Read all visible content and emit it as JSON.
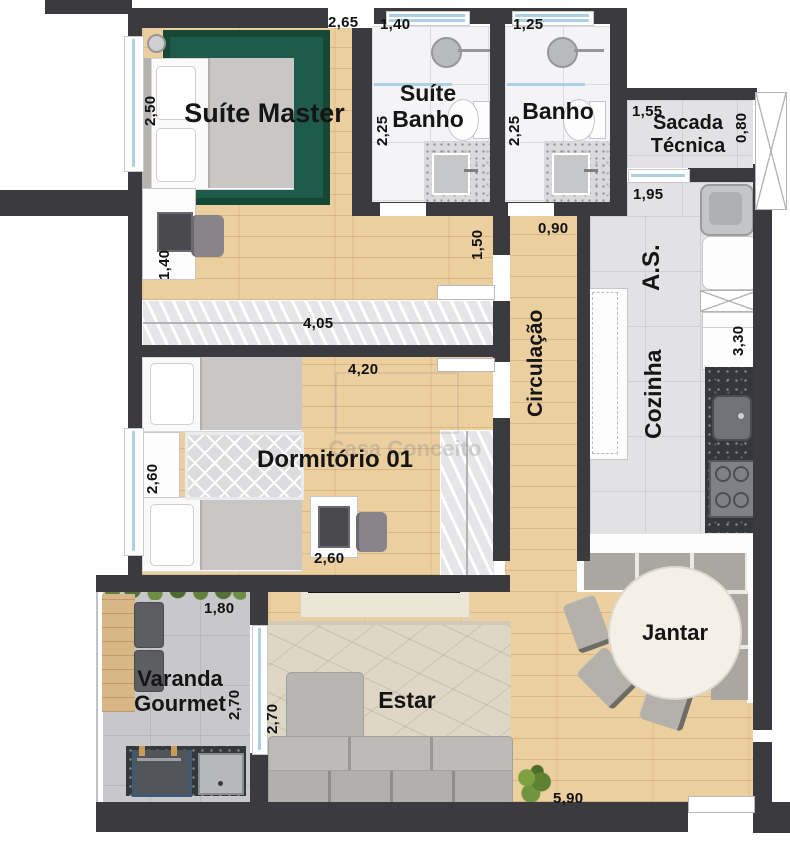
{
  "watermark": {
    "text": "Casa Conceito"
  },
  "rooms": {
    "suite_master": "Suíte Master",
    "suite_banho": "Suíte Banho",
    "banho": "Banho",
    "sacada_tecnica": "Sacada Técnica",
    "area_servico": "A.S.",
    "cozinha": "Cozinha",
    "circulacao": "Circulação",
    "dormitorio_01": "Dormitório 01",
    "varanda_gourmet": "Varanda Gourmet",
    "estar": "Estar",
    "jantar": "Jantar"
  },
  "dimensions": {
    "suite_master_width": "2,65",
    "suite_master_depth": "2,50",
    "suite_desk": "1,40",
    "suite_banho_width": "1,40",
    "suite_banho_depth": "2,25",
    "banho_width": "1,25",
    "banho_depth": "2,25",
    "sacada_width": "1,55",
    "sacada_depth": "0,80",
    "area_servico_width": "1,95",
    "cozinha_depth": "3,30",
    "circulacao_width": "0,90",
    "suite_hall": "1,50",
    "closet_width": "4,05",
    "dormitorio_width": "4,20",
    "dormitorio_depth": "2,60",
    "dormitorio_desk": "2,60",
    "varanda_width": "1,80",
    "varanda_depth": "2,70",
    "estar_depth": "2,70",
    "social_width": "5,90"
  }
}
